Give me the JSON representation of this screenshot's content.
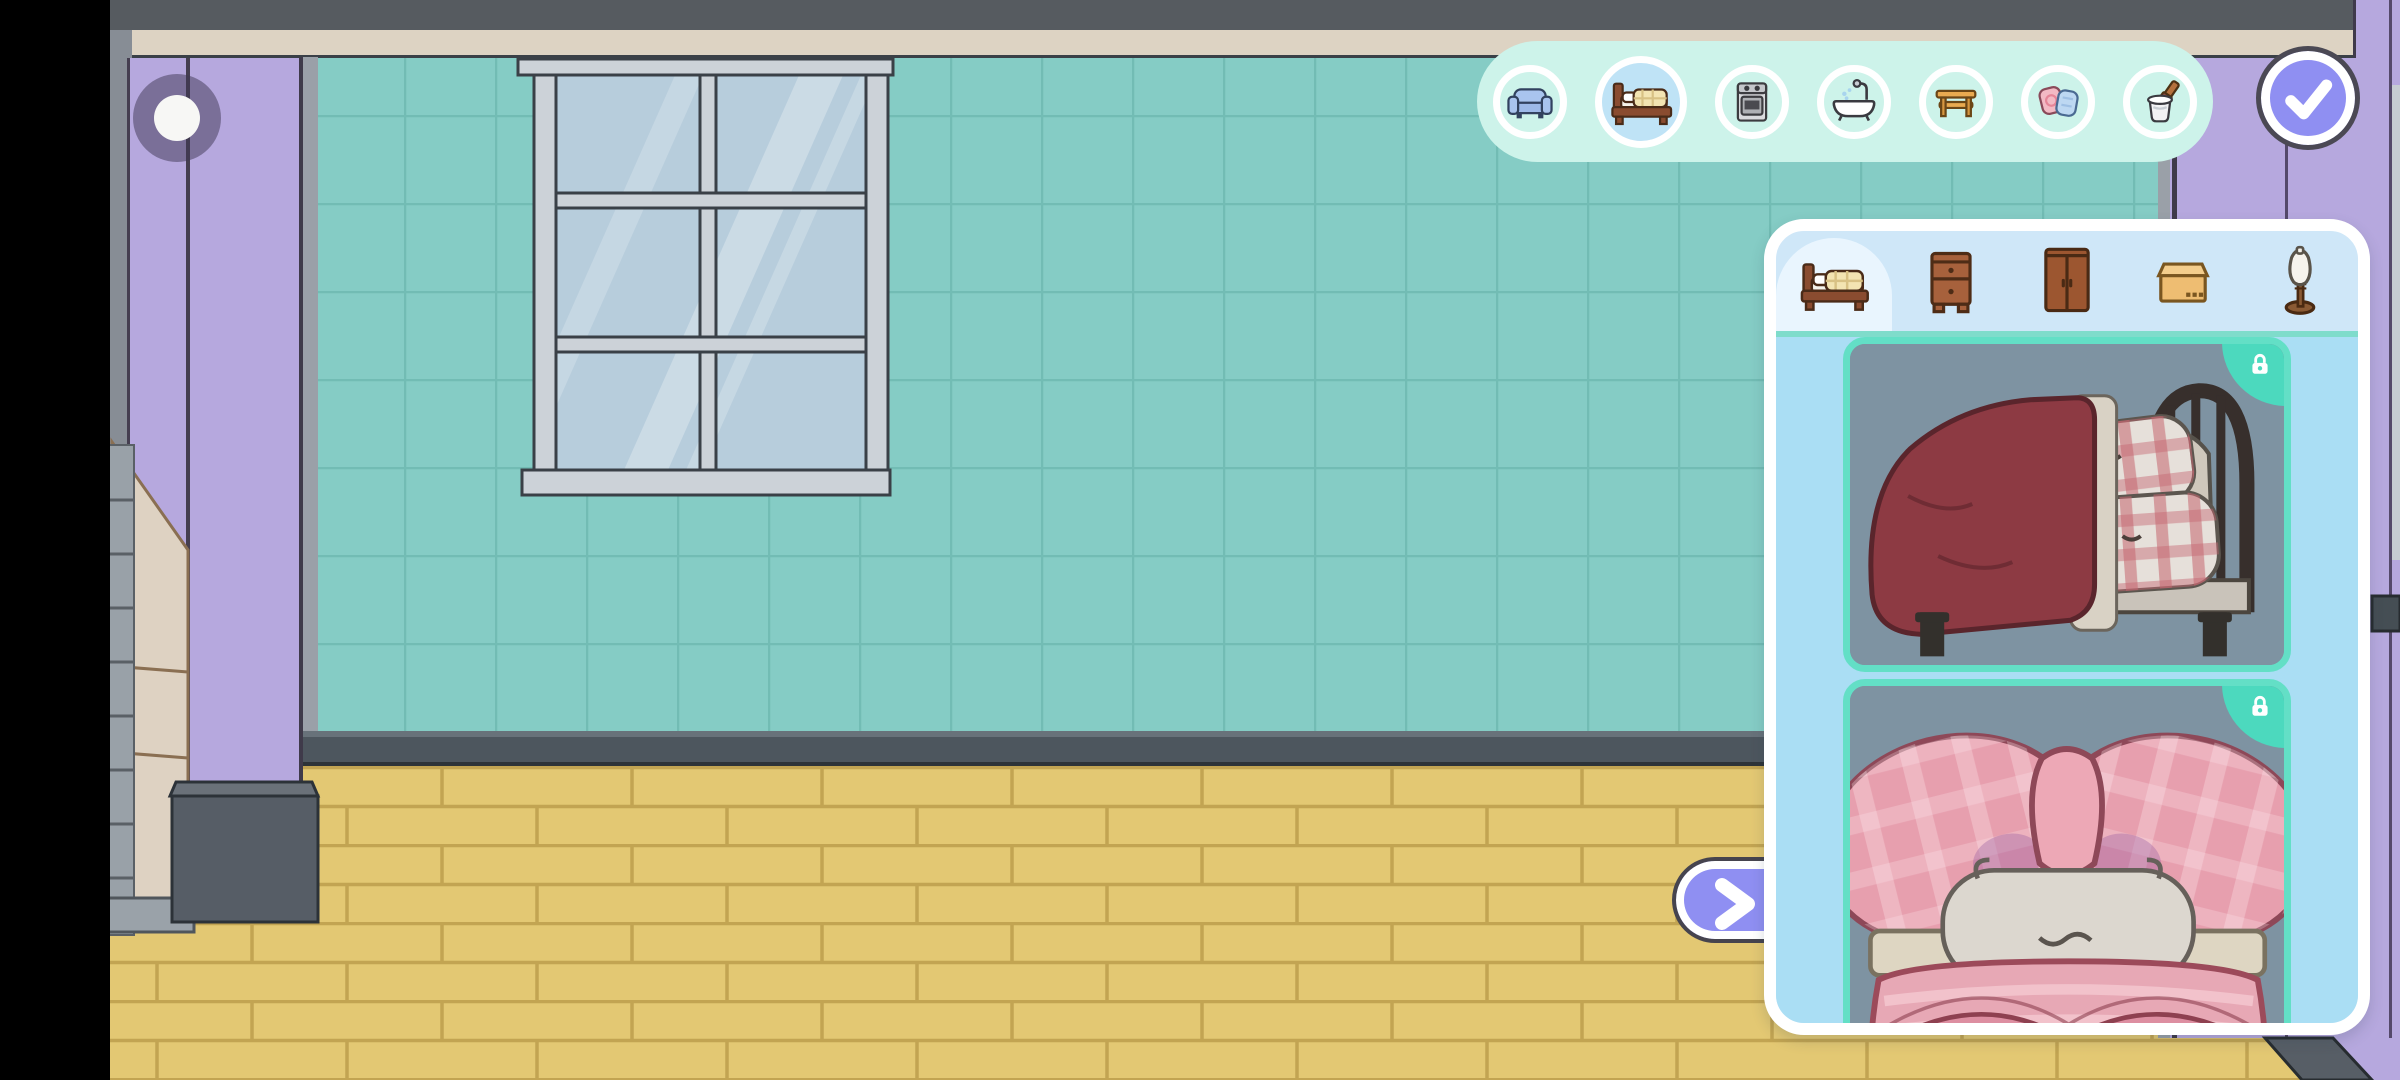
{
  "scene": {
    "type": "room-decoration-editor",
    "room": {
      "wall_color": "#85ccc5",
      "floor_color": "#e3c873",
      "pillar_color": "#b6a8de",
      "ceiling_trim_color": "#ddd3c3",
      "baseboard_color": "#4d565e",
      "elements": [
        "tiled-wall",
        "six-pane-window",
        "left-pillar",
        "right-pillar",
        "stairs",
        "brick-floor",
        "ceiling-trim"
      ]
    }
  },
  "camera_button": {
    "icon": "dot-icon"
  },
  "toolbar": {
    "background": "#cdf3ea",
    "selected_background": "#bfe3f6",
    "categories": [
      {
        "id": "sofas",
        "icon": "sofa-icon",
        "selected": false
      },
      {
        "id": "beds",
        "icon": "bed-icon",
        "selected": true
      },
      {
        "id": "appliances",
        "icon": "stove-icon",
        "selected": false
      },
      {
        "id": "bathroom",
        "icon": "bathtub-icon",
        "selected": false
      },
      {
        "id": "tables",
        "icon": "table-icon",
        "selected": false
      },
      {
        "id": "cushions",
        "icon": "cushions-icon",
        "selected": false
      },
      {
        "id": "paint",
        "icon": "paint-bucket-icon",
        "selected": false
      }
    ]
  },
  "confirm_button": {
    "icon": "check-icon",
    "color": "#8f8ff2"
  },
  "next_button": {
    "icon": "chevron-right-icon",
    "color": "#8f8ff2"
  },
  "panel": {
    "background": "#cfe7f8",
    "list_background": "#aadef4",
    "card_border_color": "#63dfc6",
    "card_background": "#7e93a2",
    "badge_color": "#4cd9be",
    "tabs": [
      {
        "id": "beds",
        "icon": "bed-icon",
        "selected": true
      },
      {
        "id": "nightstands",
        "icon": "nightstand-icon",
        "selected": false
      },
      {
        "id": "wardrobes",
        "icon": "wardrobe-icon",
        "selected": false
      },
      {
        "id": "boxes",
        "icon": "box-icon",
        "selected": false
      },
      {
        "id": "mannequins",
        "icon": "mannequin-icon",
        "selected": false
      }
    ],
    "items": [
      {
        "id": "metal-frame-bed",
        "description": "dark red blanket bed with plaid pillows",
        "locked": true,
        "badge_icon": "lock-icon"
      },
      {
        "id": "bow-bed",
        "description": "pink bow headboard bed",
        "locked": true,
        "badge_icon": "lock-icon"
      }
    ]
  }
}
